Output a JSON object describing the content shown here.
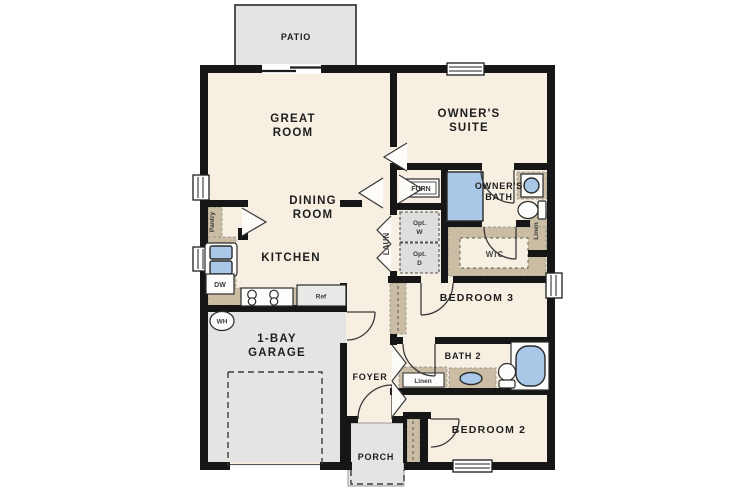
{
  "plan": {
    "rooms": {
      "patio": "PATIO",
      "great_room_l1": "GREAT",
      "great_room_l2": "ROOM",
      "owners_suite_l1": "OWNER'S",
      "owners_suite_l2": "SUITE",
      "dining_l1": "DINING",
      "dining_l2": "ROOM",
      "kitchen": "KITCHEN",
      "owners_bath_l1": "OWNER'S",
      "owners_bath_l2": "BATH",
      "wic": "WIC",
      "bedroom3": "BEDROOM 3",
      "bath2": "BATH 2",
      "bedroom2": "BEDROOM 2",
      "foyer": "FOYER",
      "garage_l1": "1-BAY",
      "garage_l2": "GARAGE",
      "porch": "PORCH"
    },
    "closets": {
      "pantry": "Pantry",
      "laundry": "LAUN",
      "linen_hall": "Linen",
      "linen_bath2": "Linen"
    },
    "appliances": {
      "furnace": "FURN",
      "dishwasher": "DW",
      "refrigerator": "Ref",
      "water_heater": "WH",
      "opt_washer_l1": "Opt.",
      "opt_washer_l2": "W",
      "opt_dryer_l1": "Opt.",
      "opt_dryer_l2": "D"
    },
    "colors": {
      "wall": "#161616",
      "floor": "#f6efe2",
      "counter": "#cbbda3",
      "fixture_blue": "#a9c7e6",
      "outdoor_gray": "#e4e4e2"
    }
  }
}
